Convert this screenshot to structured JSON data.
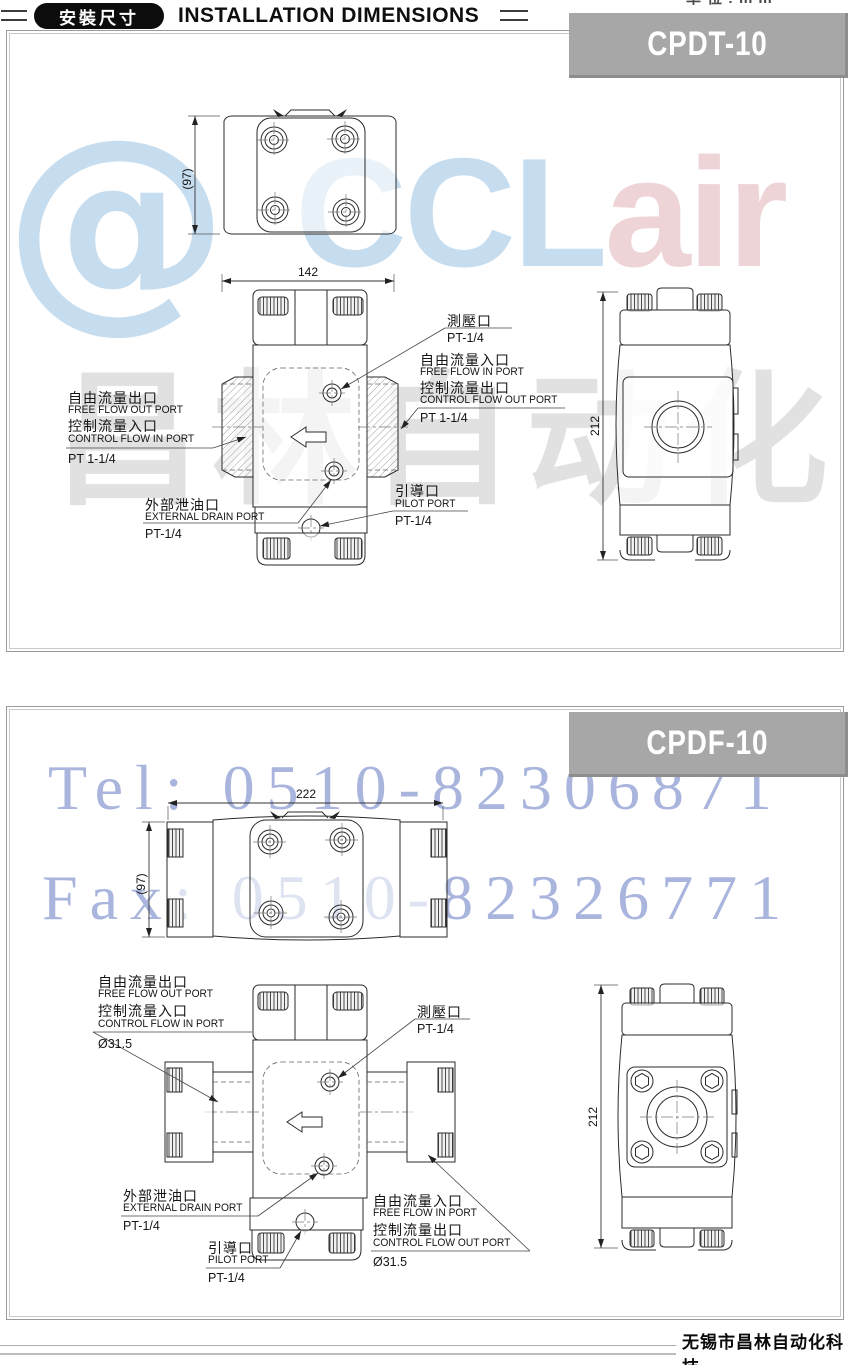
{
  "header": {
    "badge": "安裝尺寸",
    "title": "INSTALLATION DIMENSIONS",
    "top_note": "单位:mm"
  },
  "watermarks": {
    "logo_at": "@",
    "logo_main": "CCL",
    "logo_tail": "air",
    "gray_text": "昌林自动化",
    "tel": "Tel: 0510-82306871",
    "fax": "Fax: 0510-82326771",
    "colors": {
      "logo_blue": "#c6ddf0",
      "logo_pink": "#eed3d7",
      "phone_blue": "#7488c8",
      "watermark_gray": "#d9d9d9",
      "banner_gray": "#a7a7a7"
    }
  },
  "footer": {
    "company": "无锡市昌林自动化科技"
  },
  "panel1": {
    "model": "CPDT-10",
    "dims": {
      "width": "142",
      "depth": "(97)",
      "height": "212"
    },
    "labels": {
      "gauge_cn": "測壓口",
      "gauge_size": "PT-1/4",
      "free_in_cn": "自由流量入口",
      "free_in_en": "FREE FLOW IN PORT",
      "ctrl_out_cn": "控制流量出口",
      "ctrl_out_en": "CONTROL FLOW OUT PORT",
      "right_size": "PT 1-1/4",
      "free_out_cn": "自由流量出口",
      "free_out_en": "FREE FLOW OUT PORT",
      "ctrl_in_cn": "控制流量入口",
      "ctrl_in_en": "CONTROL FLOW IN PORT",
      "left_size": "PT 1-1/4",
      "drain_cn": "外部泄油口",
      "drain_en": "EXTERNAL DRAIN PORT",
      "drain_size": "PT-1/4",
      "pilot_cn": "引導口",
      "pilot_en": "PILOT PORT",
      "pilot_size": "PT-1/4"
    }
  },
  "panel2": {
    "model": "CPDF-10",
    "dims": {
      "width": "222",
      "depth": "(97)",
      "height": "212"
    },
    "labels": {
      "gauge_cn": "測壓口",
      "gauge_size": "PT-1/4",
      "free_in_cn": "自由流量入口",
      "free_in_en": "FREE FLOW IN PORT",
      "ctrl_out_cn": "控制流量出口",
      "ctrl_out_en": "CONTROL FLOW OUT PORT",
      "right_size": "Ø31.5",
      "free_out_cn": "自由流量出口",
      "free_out_en": "FREE FLOW OUT PORT",
      "ctrl_in_cn": "控制流量入口",
      "ctrl_in_en": "CONTROL FLOW IN PORT",
      "left_size": "Ø31.5",
      "drain_cn": "外部泄油口",
      "drain_en": "EXTERNAL DRAIN PORT",
      "drain_size": "PT-1/4",
      "pilot_cn": "引導口",
      "pilot_en": "PILOT PORT",
      "pilot_size": "PT-1/4"
    }
  }
}
